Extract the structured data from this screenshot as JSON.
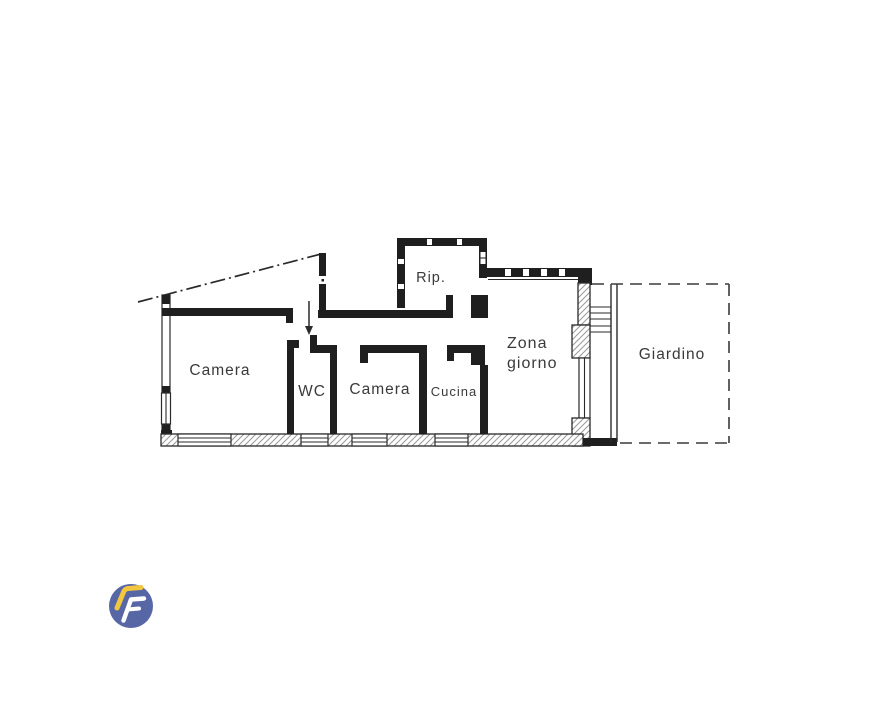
{
  "page": {
    "background_color": "#ffffff",
    "type": "floor-plan-image"
  },
  "floorplan": {
    "ink_color": "#2a2a2a",
    "hatch_color": "#9a9a9a",
    "rooms": [
      {
        "id": "camera-1",
        "label": "Camera"
      },
      {
        "id": "wc",
        "label": "WC"
      },
      {
        "id": "camera-2",
        "label": "Camera"
      },
      {
        "id": "cucina",
        "label": "Cucina"
      },
      {
        "id": "zona-giorno",
        "label_line_1": "Zona",
        "label_line_2": "giorno"
      },
      {
        "id": "ripostiglio",
        "label": "Rip."
      },
      {
        "id": "giardino",
        "label": "Giardino"
      }
    ]
  },
  "logo": {
    "letter": "F",
    "circle_color": "#5767a6",
    "roof_color": "#f2c63e",
    "letter_color": "#ffffff"
  }
}
